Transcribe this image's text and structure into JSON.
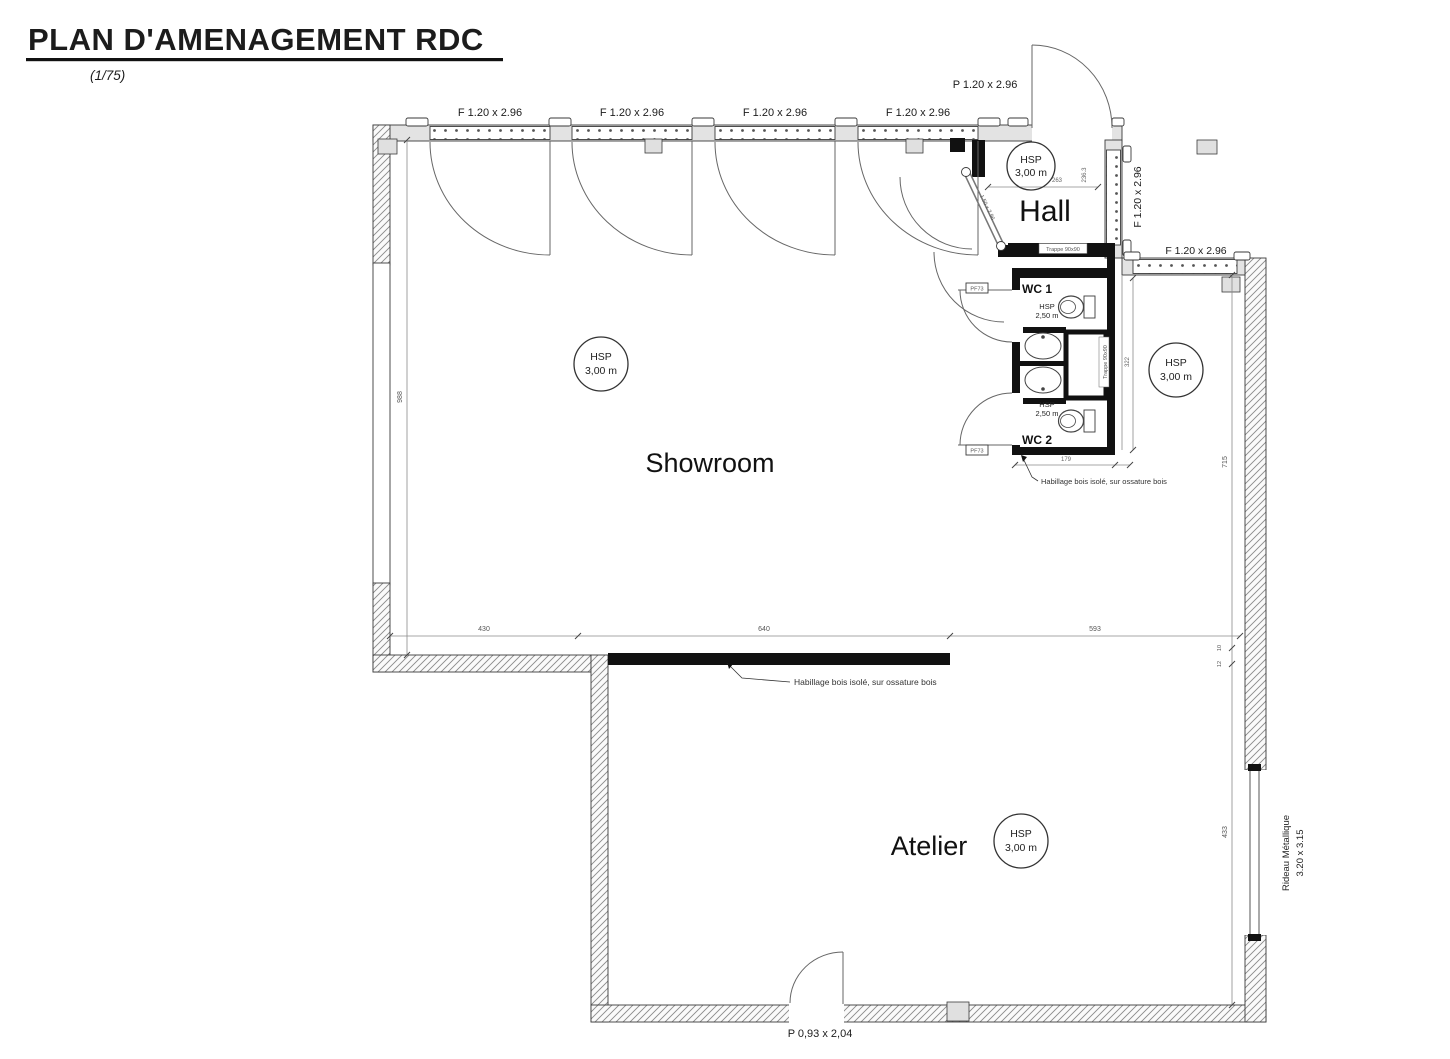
{
  "header": {
    "title": "PLAN D'AMENAGEMENT RDC",
    "scale": "(1/75)"
  },
  "rooms": {
    "showroom": "Showroom",
    "hall": "Hall",
    "atelier": "Atelier",
    "wc1": "WC 1",
    "wc2": "WC 2"
  },
  "hsp": {
    "label": "HSP",
    "h300": "3,00 m",
    "h250": "2,50 m"
  },
  "openings": {
    "window_f": "F 1.20 x 2.96",
    "door_entry": "P 1.20 x 2.96",
    "door_atelier": "P 0,93 x 2,04",
    "door_wc_tag": "PF73",
    "door_hall_diag": "1.50 x 2.96",
    "rideau_line1": "Rideau Métallique",
    "rideau_line2": "3.20 x 3.15",
    "trappe": "Trappe 90x90"
  },
  "annotations": {
    "habillage": "Habillage bois isolé, sur ossature bois"
  },
  "dims": {
    "d430": "430",
    "d640": "640",
    "d593": "593",
    "d988": "988",
    "d715": "715",
    "d433": "433",
    "d322": "322",
    "d179": "179",
    "hall_a": "263",
    "hall_b": "236.3",
    "step_a": "10",
    "step_b": "12"
  }
}
